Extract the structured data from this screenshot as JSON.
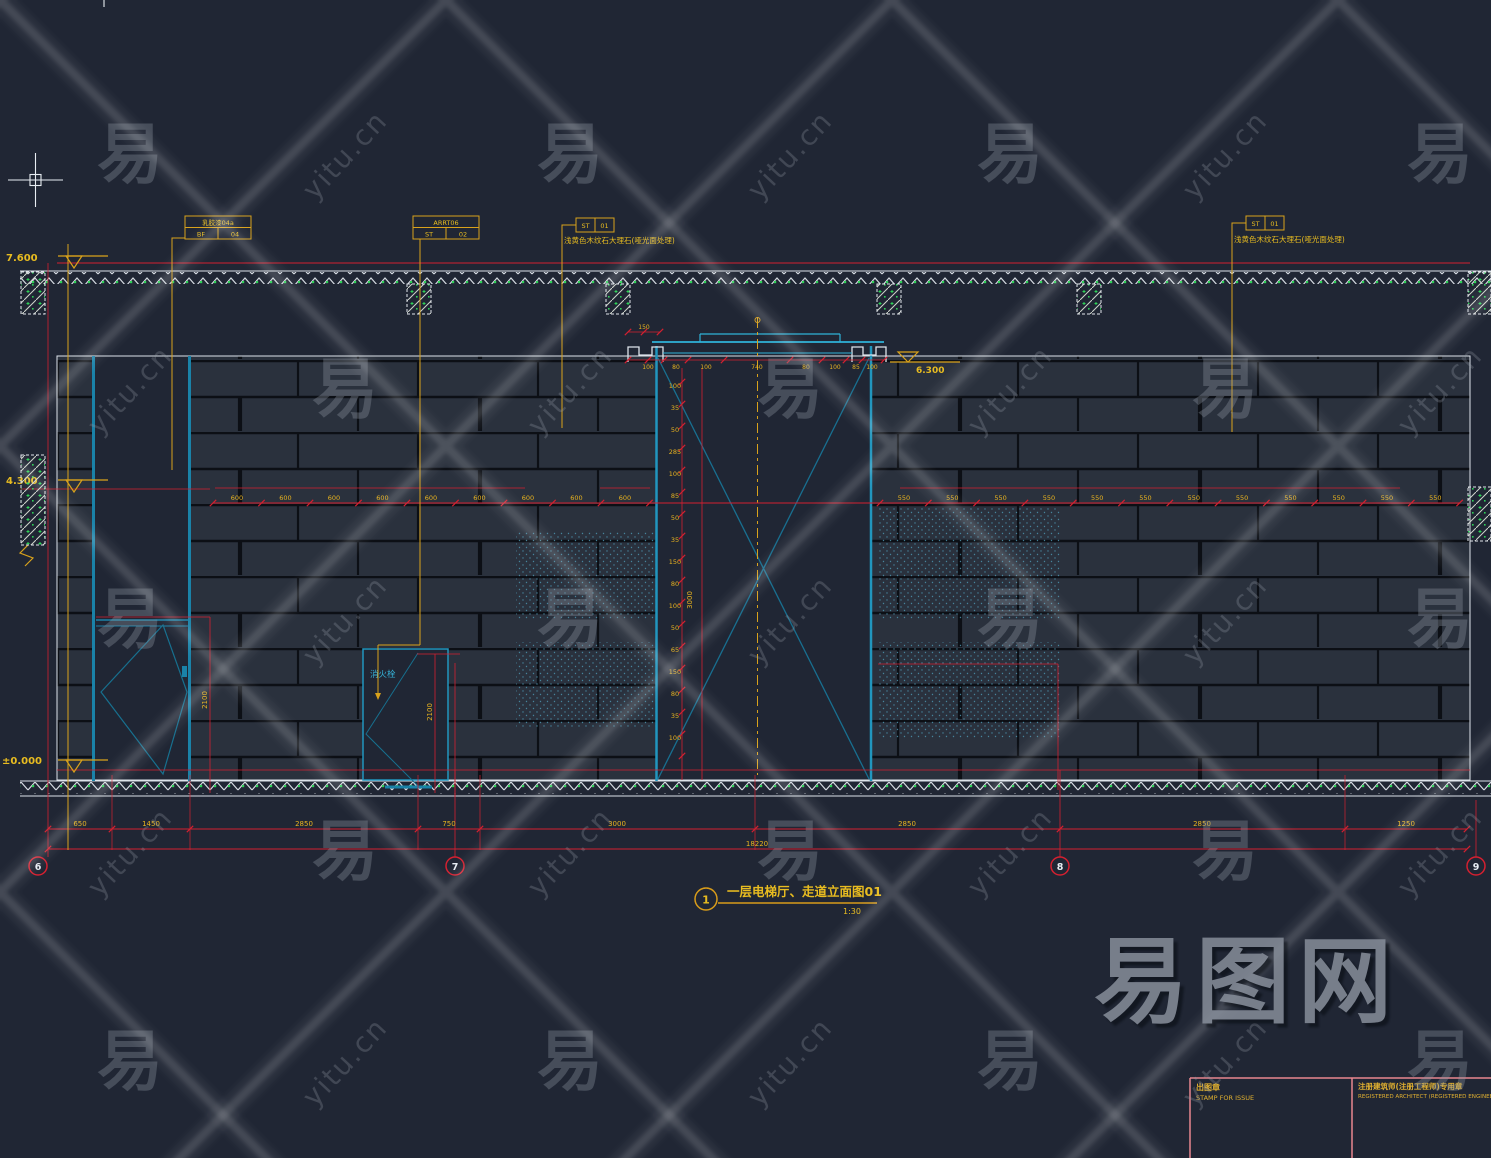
{
  "watermark": {
    "char": "易",
    "site": "yitu.cn",
    "logo": "易图网"
  },
  "drawing_title": {
    "num": "1",
    "name": "一层电梯厅、走道立面图01",
    "scale": "1:30"
  },
  "levels": {
    "top": "7.600",
    "mid": "4.300",
    "zero": "±0.000",
    "opening": "6.300"
  },
  "axis": [
    "6",
    "7",
    "8",
    "9"
  ],
  "callouts": {
    "c1": {
      "title": "乳胶漆04a",
      "left": "BF",
      "right": "04"
    },
    "c2": {
      "title": "ARRT06",
      "left": "ST",
      "right": "02"
    },
    "c3": {
      "left": "ST",
      "right": "01",
      "note": "浅黄色木纹石大理石(哑光面处理)"
    },
    "c4": {
      "left": "ST",
      "right": "01",
      "note": "浅黄色木纹石大理石(哑光面处理)"
    }
  },
  "labels": {
    "hydrant": "消火栓",
    "door_left_h": "2100",
    "door_fire_h": "2100",
    "opening_h": "3000",
    "seg_150": "150",
    "total": "18220"
  },
  "dims": {
    "mid_left": [
      "600",
      "600",
      "600",
      "600",
      "600",
      "600",
      "600",
      "600",
      "600"
    ],
    "mid_right": [
      "550",
      "550",
      "550",
      "550",
      "550",
      "550",
      "550",
      "550",
      "550",
      "550",
      "550",
      "550"
    ],
    "vert": [
      "100",
      "35",
      "50",
      "285",
      "100",
      "85",
      "50",
      "35",
      "150",
      "80",
      "100",
      "50",
      "65",
      "150",
      "80",
      "35",
      "100"
    ],
    "top_small": [
      "100",
      "80",
      "100",
      "740",
      "80",
      "100",
      "85",
      "100"
    ],
    "bottom": [
      "650",
      "1450",
      "2850",
      "750",
      "3000",
      "2850",
      "2850",
      "1250"
    ]
  },
  "titleblock": {
    "stamp_cn": "出图章",
    "stamp_en": "STAMP FOR ISSUE",
    "reg_cn": "注册建筑师(注册工程师)专用章",
    "reg_en": "REGISTERED ARCHITECT (REGISTERED ENGINEER) STAMP"
  }
}
